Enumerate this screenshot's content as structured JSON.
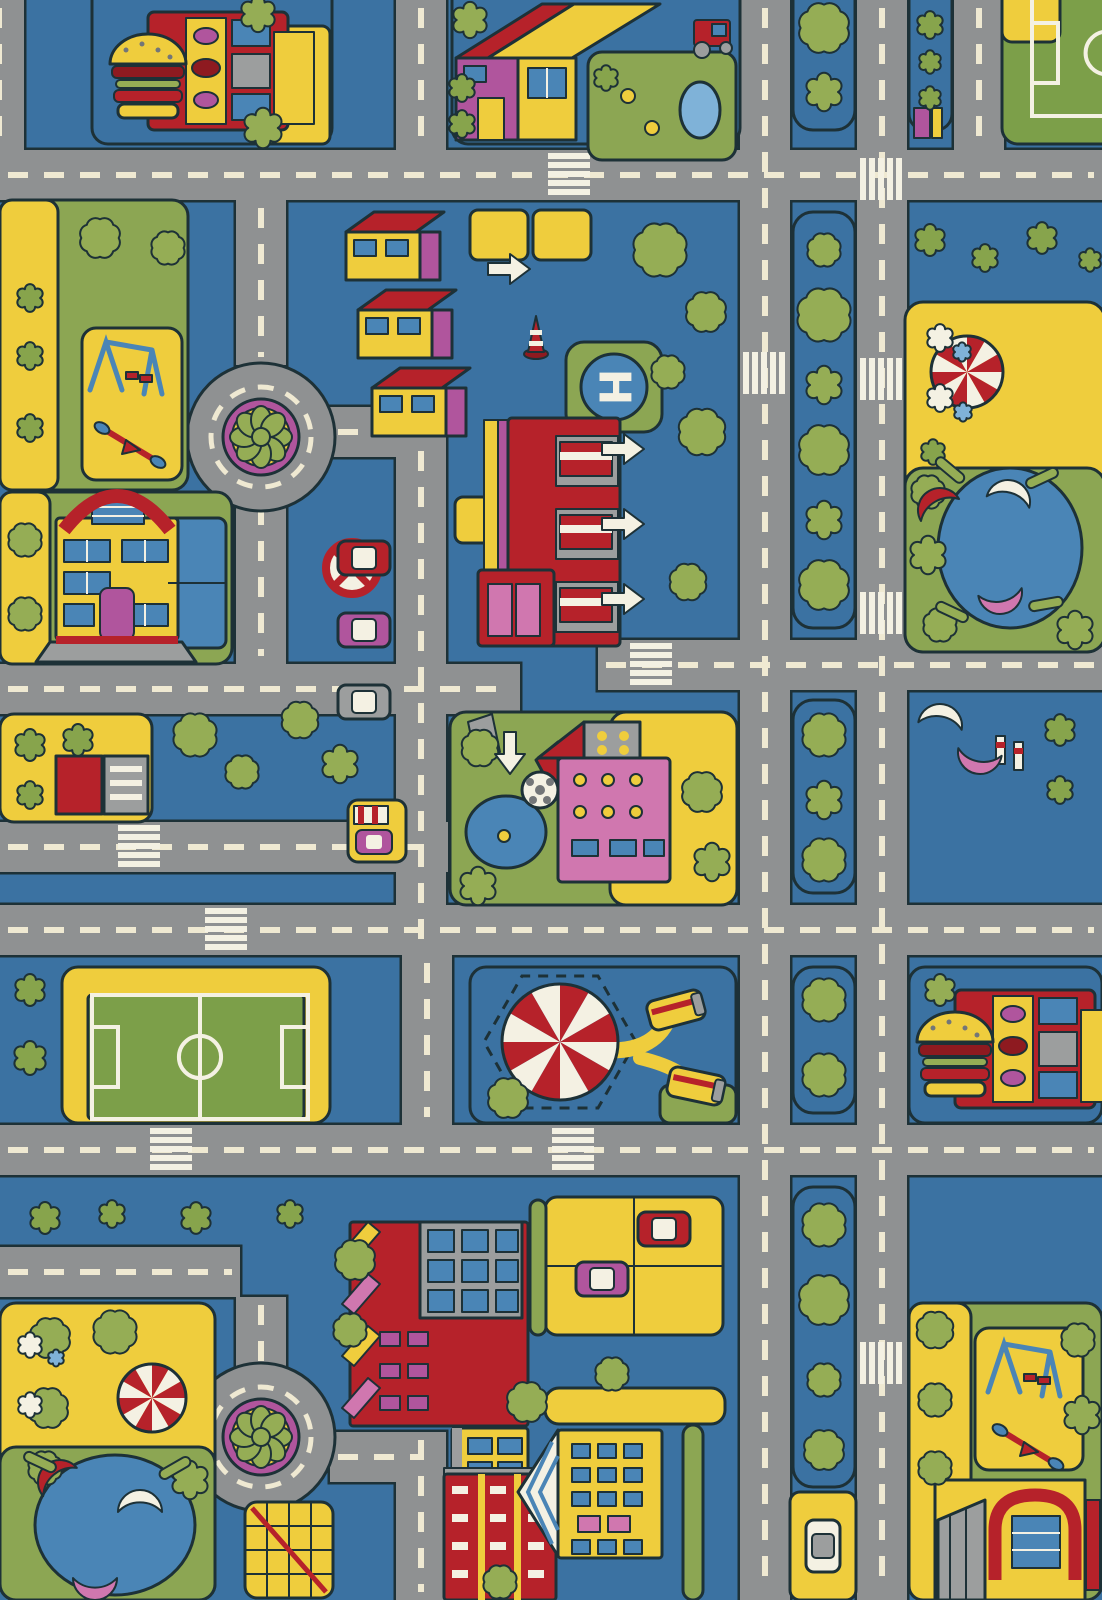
{
  "title": "City Roads Play Rug",
  "helipad": {
    "label": "H"
  },
  "palette": {
    "bg": "#3b72a2",
    "road": "#8f9192",
    "dash": "#efe9d2",
    "outline": "#1d3137",
    "lawn": "#8ca653",
    "pitch": "#7c9f49",
    "tree": "#95ad55",
    "bush": "#87a44c",
    "sand": "#efcd3d",
    "red": "#b6222a",
    "darkred": "#8e1a20",
    "magenta": "#b0559d",
    "pink": "#d077af",
    "water": "#4a85b6",
    "pond": "#7fb2d8",
    "white": "#f4f1e3",
    "gray": "#9c9e9e",
    "dgray": "#737678"
  },
  "scene": {
    "road_w": 50,
    "roads_h": [
      [
        0,
        150,
        1102
      ],
      [
        0,
        664,
        520
      ],
      [
        598,
        640,
        504
      ],
      [
        0,
        822,
        448
      ],
      [
        0,
        905,
        1102
      ],
      [
        0,
        1125,
        1102
      ],
      [
        0,
        1247,
        240
      ],
      [
        330,
        407,
        96
      ],
      [
        330,
        1432,
        96
      ]
    ],
    "roads_v": [
      [
        -26,
        0,
        150
      ],
      [
        396,
        0,
        150
      ],
      [
        740,
        0,
        1600
      ],
      [
        857,
        0,
        1600
      ],
      [
        954,
        0,
        150
      ],
      [
        236,
        200,
        165
      ],
      [
        236,
        497,
        167
      ],
      [
        396,
        407,
        548
      ],
      [
        402,
        955,
        170
      ],
      [
        236,
        1297,
        75
      ],
      [
        396,
        1432,
        168
      ],
      [
        484,
        714,
        76
      ]
    ],
    "zebras": [
      [
        860,
        158,
        "v"
      ],
      [
        860,
        358,
        "v"
      ],
      [
        860,
        592,
        "v"
      ],
      [
        743,
        352,
        "v"
      ],
      [
        860,
        1342,
        "v"
      ],
      [
        548,
        153,
        "h"
      ],
      [
        630,
        643,
        "h"
      ],
      [
        118,
        825,
        "h"
      ],
      [
        205,
        908,
        "h"
      ],
      [
        552,
        1128,
        "h"
      ],
      [
        150,
        1128,
        "h"
      ]
    ],
    "roundabouts": [
      [
        261,
        437
      ],
      [
        261,
        1437
      ]
    ],
    "blocks": [
      [
        793,
        -20,
        62,
        150,
        "bg",
        20
      ],
      [
        793,
        212,
        62,
        416,
        "bg",
        20
      ],
      [
        793,
        700,
        62,
        193,
        "bg",
        20
      ],
      [
        793,
        967,
        62,
        146,
        "bg",
        20
      ],
      [
        793,
        1187,
        62,
        300,
        "bg",
        20
      ],
      [
        909,
        -20,
        43,
        150,
        "bg",
        16
      ],
      [
        92,
        -22,
        240,
        166,
        "bg",
        16
      ],
      [
        252,
        26,
        78,
        118,
        "sand",
        8
      ],
      [
        452,
        -22,
        288,
        166,
        "bg",
        16
      ],
      [
        588,
        52,
        148,
        108,
        "lawn",
        14
      ],
      [
        1002,
        -22,
        122,
        166,
        "pitch",
        16
      ],
      [
        1002,
        -22,
        58,
        64,
        "sand",
        10
      ],
      [
        0,
        200,
        188,
        290,
        "lawn",
        16
      ],
      [
        0,
        200,
        58,
        290,
        "sand",
        12
      ],
      [
        82,
        328,
        100,
        152,
        "sand",
        14
      ],
      [
        0,
        492,
        232,
        172,
        "lawn",
        16
      ],
      [
        0,
        492,
        50,
        172,
        "sand",
        12
      ],
      [
        168,
        518,
        58,
        130,
        "water",
        8
      ],
      [
        905,
        302,
        200,
        350,
        "sand",
        18
      ],
      [
        905,
        468,
        200,
        184,
        "lawn",
        18
      ],
      [
        0,
        714,
        152,
        108,
        "sand",
        14
      ],
      [
        450,
        712,
        287,
        193,
        "lawn",
        16
      ],
      [
        610,
        712,
        127,
        193,
        "sand",
        16
      ],
      [
        62,
        967,
        268,
        156,
        "sand",
        16
      ],
      [
        88,
        995,
        216,
        124,
        "pitch",
        4
      ],
      [
        470,
        967,
        266,
        156,
        "bg",
        16
      ],
      [
        660,
        1085,
        76,
        38,
        "lawn",
        10
      ],
      [
        909,
        967,
        193,
        156,
        "bg",
        16
      ],
      [
        0,
        1303,
        215,
        297,
        "sand",
        16
      ],
      [
        0,
        1447,
        215,
        153,
        "lawn",
        16
      ],
      [
        909,
        1303,
        193,
        297,
        "lawn",
        16
      ],
      [
        909,
        1303,
        62,
        297,
        "sand",
        14
      ],
      [
        975,
        1328,
        108,
        142,
        "sand",
        14
      ],
      [
        545,
        1197,
        178,
        138,
        "sand",
        12
      ],
      [
        790,
        1492,
        66,
        108,
        "sand",
        10
      ],
      [
        470,
        210,
        58,
        50,
        "sand",
        8
      ],
      [
        533,
        210,
        58,
        50,
        "sand",
        8
      ],
      [
        455,
        497,
        48,
        46,
        "sand",
        8
      ],
      [
        348,
        800,
        58,
        62,
        "sand",
        10
      ],
      [
        566,
        342,
        96,
        90,
        "lawn",
        18
      ],
      [
        683,
        1425,
        20,
        175,
        "lawn",
        10
      ],
      [
        530,
        1200,
        16,
        135,
        "lawn",
        8
      ],
      [
        545,
        1388,
        180,
        36,
        "sand",
        14
      ],
      [
        245,
        1502,
        88,
        96,
        "sand",
        12
      ]
    ],
    "pitches": [
      [
        92,
        995,
        216,
        124
      ]
    ],
    "pitch_clipped": [
      1032,
      -10,
      150,
      126
    ],
    "tents": [
      [
        560,
        1042,
        58
      ],
      [
        967,
        372,
        36
      ],
      [
        152,
        1398,
        34
      ]
    ],
    "playgrounds": [
      [
        82,
        328
      ],
      [
        980,
        1330
      ]
    ],
    "burgers": [
      [
        108,
        2
      ],
      [
        915,
        980
      ]
    ],
    "buses": [
      [
        676,
        1010,
        -15
      ],
      [
        696,
        1086,
        12
      ]
    ],
    "boats": [
      [
        940,
        510,
        -30,
        "red"
      ],
      [
        1008,
        502,
        15,
        "white"
      ],
      [
        1000,
        592,
        170,
        "pink"
      ],
      [
        60,
        1482,
        -40,
        "red"
      ],
      [
        140,
        1512,
        0,
        "white"
      ],
      [
        95,
        1578,
        180,
        "pink"
      ],
      [
        940,
        726,
        10,
        "white"
      ],
      [
        980,
        752,
        190,
        "pink"
      ]
    ],
    "benches": [
      [
        950,
        470,
        40
      ],
      [
        1042,
        478,
        -25
      ],
      [
        952,
        612,
        25
      ],
      [
        1046,
        604,
        -10
      ],
      [
        40,
        1462,
        25
      ],
      [
        175,
        1468,
        -30
      ]
    ],
    "cars": [
      [
        364,
        558,
        "red",
        0
      ],
      [
        364,
        630,
        "magenta",
        0
      ],
      [
        364,
        702,
        "gray",
        0
      ],
      [
        664,
        1229,
        "red",
        0
      ],
      [
        602,
        1279,
        "magenta",
        0
      ],
      [
        823,
        1546,
        "white",
        90
      ]
    ],
    "arrows": [
      [
        488,
        254,
        "r"
      ],
      [
        602,
        434,
        "r"
      ],
      [
        602,
        509,
        "r"
      ],
      [
        602,
        584,
        "r"
      ],
      [
        489,
        738,
        "d"
      ]
    ],
    "trees": [
      [
        824,
        28,
        30,
        "t"
      ],
      [
        824,
        92,
        18,
        "t"
      ],
      [
        824,
        250,
        20,
        "t"
      ],
      [
        824,
        315,
        32,
        "t"
      ],
      [
        824,
        385,
        18,
        "t"
      ],
      [
        824,
        450,
        30,
        "t"
      ],
      [
        824,
        520,
        18,
        "t"
      ],
      [
        824,
        585,
        30,
        "t"
      ],
      [
        824,
        735,
        26,
        "t"
      ],
      [
        824,
        800,
        18,
        "t"
      ],
      [
        824,
        860,
        26,
        "t"
      ],
      [
        824,
        1000,
        26,
        "t"
      ],
      [
        824,
        1075,
        26,
        "t"
      ],
      [
        824,
        1225,
        26,
        "t"
      ],
      [
        824,
        1300,
        30,
        "t"
      ],
      [
        824,
        1380,
        20,
        "t"
      ],
      [
        824,
        1450,
        24,
        "t"
      ],
      [
        930,
        25,
        13,
        "b"
      ],
      [
        930,
        62,
        11,
        "b"
      ],
      [
        930,
        98,
        11,
        "b"
      ],
      [
        258,
        14,
        17,
        "t"
      ],
      [
        263,
        128,
        19,
        "t"
      ],
      [
        470,
        20,
        17,
        "t"
      ],
      [
        462,
        88,
        13,
        "b"
      ],
      [
        462,
        124,
        13,
        "b"
      ],
      [
        606,
        78,
        12,
        "b"
      ],
      [
        930,
        240,
        15,
        "b"
      ],
      [
        985,
        258,
        13,
        "b"
      ],
      [
        1042,
        238,
        15,
        "b"
      ],
      [
        1090,
        260,
        11,
        "b"
      ],
      [
        100,
        238,
        24,
        "t"
      ],
      [
        168,
        248,
        20,
        "t"
      ],
      [
        30,
        298,
        13,
        "b"
      ],
      [
        30,
        356,
        13,
        "b"
      ],
      [
        30,
        428,
        13,
        "b"
      ],
      [
        25,
        540,
        20,
        "t"
      ],
      [
        25,
        614,
        20,
        "t"
      ],
      [
        660,
        250,
        32,
        "t"
      ],
      [
        706,
        312,
        24,
        "t"
      ],
      [
        668,
        372,
        20,
        "t"
      ],
      [
        702,
        432,
        28,
        "t"
      ],
      [
        688,
        582,
        22,
        "t"
      ],
      [
        300,
        720,
        22,
        "t"
      ],
      [
        340,
        764,
        18,
        "t"
      ],
      [
        480,
        748,
        22,
        "t"
      ],
      [
        478,
        886,
        18,
        "t"
      ],
      [
        702,
        792,
        24,
        "t"
      ],
      [
        712,
        862,
        18,
        "t"
      ],
      [
        30,
        745,
        15,
        "b"
      ],
      [
        78,
        740,
        15,
        "b"
      ],
      [
        30,
        795,
        13,
        "b"
      ],
      [
        195,
        735,
        26,
        "t"
      ],
      [
        242,
        772,
        20,
        "t"
      ],
      [
        508,
        1098,
        24,
        "t"
      ],
      [
        30,
        990,
        15,
        "b"
      ],
      [
        30,
        1058,
        16,
        "b"
      ],
      [
        940,
        990,
        15,
        "t"
      ],
      [
        45,
        1218,
        15,
        "b"
      ],
      [
        112,
        1214,
        13,
        "b"
      ],
      [
        196,
        1218,
        15,
        "b"
      ],
      [
        290,
        1214,
        13,
        "b"
      ],
      [
        50,
        1338,
        24,
        "t"
      ],
      [
        115,
        1332,
        26,
        "t"
      ],
      [
        48,
        1408,
        24,
        "t"
      ],
      [
        45,
        1468,
        20,
        "t"
      ],
      [
        190,
        1480,
        18,
        "t"
      ],
      [
        527,
        1402,
        24,
        "t"
      ],
      [
        612,
        1374,
        20,
        "t"
      ],
      [
        500,
        1582,
        20,
        "t"
      ],
      [
        935,
        1330,
        22,
        "t"
      ],
      [
        935,
        1400,
        20,
        "t"
      ],
      [
        935,
        1468,
        20,
        "t"
      ],
      [
        1078,
        1340,
        20,
        "t"
      ],
      [
        1082,
        1415,
        18,
        "t"
      ],
      [
        355,
        1260,
        24,
        "t"
      ],
      [
        350,
        1330,
        20,
        "t"
      ],
      [
        1060,
        730,
        15,
        "b"
      ],
      [
        1060,
        790,
        13,
        "b"
      ],
      [
        928,
        492,
        20,
        "t"
      ],
      [
        928,
        555,
        18,
        "t"
      ],
      [
        940,
        625,
        20,
        "t"
      ],
      [
        1075,
        630,
        18,
        "t"
      ],
      [
        940,
        338,
        13,
        "w"
      ],
      [
        962,
        352,
        9,
        "q"
      ],
      [
        940,
        398,
        13,
        "w"
      ],
      [
        963,
        412,
        9,
        "q"
      ],
      [
        933,
        452,
        12,
        "b"
      ],
      [
        30,
        1345,
        12,
        "w"
      ],
      [
        56,
        1358,
        8,
        "q"
      ],
      [
        30,
        1405,
        12,
        "w"
      ]
    ],
    "landmark_names": [
      "burger-stand",
      "farm-house",
      "tractor",
      "soccer-field",
      "roundabout",
      "row-houses",
      "helipad",
      "fire-station",
      "mansion",
      "no-stopping-sign",
      "traffic-cone",
      "school",
      "duck-pond",
      "carousel-tent",
      "boating-lake",
      "playground",
      "truck-depot",
      "bus-stop",
      "apartments",
      "church",
      "parking-lot",
      "tree-lined-avenue",
      "jungle-gym"
    ]
  }
}
